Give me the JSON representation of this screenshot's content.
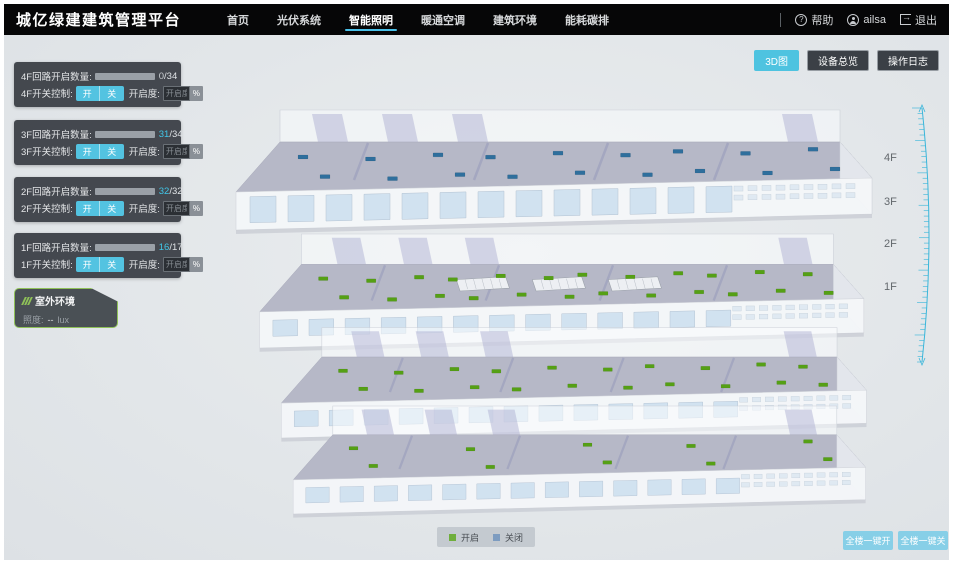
{
  "header": {
    "brand": "城亿绿建建筑管理平台",
    "nav": [
      {
        "label": "首页",
        "active": false
      },
      {
        "label": "光伏系统",
        "active": false
      },
      {
        "label": "智能照明",
        "active": true
      },
      {
        "label": "暖通空调",
        "active": false
      },
      {
        "label": "建筑环境",
        "active": false
      },
      {
        "label": "能耗碳排",
        "active": false
      }
    ],
    "help_label": "帮助",
    "user_name": "ailsa",
    "logout_label": "退出"
  },
  "icons": {
    "help_glyph": "?",
    "logout_glyph": "→"
  },
  "view_buttons": {
    "view_3d": "3D图",
    "device_overview": "设备总览",
    "operation_log": "操作日志"
  },
  "floor_panels": [
    {
      "floor": "4F",
      "circuit_label": "4F回路开启数量:",
      "open": 0,
      "total": 34,
      "switch_label": "4F开关控制:",
      "on_label": "开",
      "off_label": "关",
      "dim_label": "开启度:",
      "dim_placeholder": "开启度",
      "unit_label": "%"
    },
    {
      "floor": "3F",
      "circuit_label": "3F回路开启数量:",
      "open": 31,
      "total": 34,
      "switch_label": "3F开关控制:",
      "on_label": "开",
      "off_label": "关",
      "dim_label": "开启度:",
      "dim_placeholder": "开启度",
      "unit_label": "%"
    },
    {
      "floor": "2F",
      "circuit_label": "2F回路开启数量:",
      "open": 32,
      "total": 32,
      "switch_label": "2F开关控制:",
      "on_label": "开",
      "off_label": "关",
      "dim_label": "开启度:",
      "dim_placeholder": "开启度",
      "unit_label": "%"
    },
    {
      "floor": "1F",
      "circuit_label": "1F回路开启数量:",
      "open": 16,
      "total": 17,
      "switch_label": "1F开关控制:",
      "on_label": "开",
      "off_label": "关",
      "dim_label": "开启度:",
      "dim_placeholder": "开启度",
      "unit_label": "%"
    }
  ],
  "outdoor_panel": {
    "title": "室外环境",
    "illuminance_label": "照度:",
    "illuminance_value": "--",
    "illuminance_unit": "lux"
  },
  "floor_labels": [
    "4F",
    "3F",
    "2F",
    "1F"
  ],
  "legend": {
    "on_label": "开启",
    "off_label": "关闭",
    "on_color": "#6fae3c",
    "off_color": "#7d9cc0"
  },
  "footer_buttons": {
    "all_on": "全楼一键开",
    "all_off": "全楼一键关"
  },
  "colors": {
    "accent": "#4ec3e0",
    "progress_fill": "#41b9dd",
    "marker_on": "#55a015",
    "marker_off": "#2f6f9d",
    "ruler": "#3ab6da"
  },
  "building": {
    "floors": [
      {
        "name": "4F",
        "status": "off",
        "marker_color": "#2f6f9d",
        "marker_count": 18
      },
      {
        "name": "3F",
        "status": "on",
        "marker_color": "#55a015",
        "marker_count": 24
      },
      {
        "name": "2F",
        "status": "on",
        "marker_color": "#55a015",
        "marker_count": 20
      },
      {
        "name": "1F",
        "status": "on",
        "marker_color": "#55a015",
        "marker_count": 10
      }
    ]
  }
}
